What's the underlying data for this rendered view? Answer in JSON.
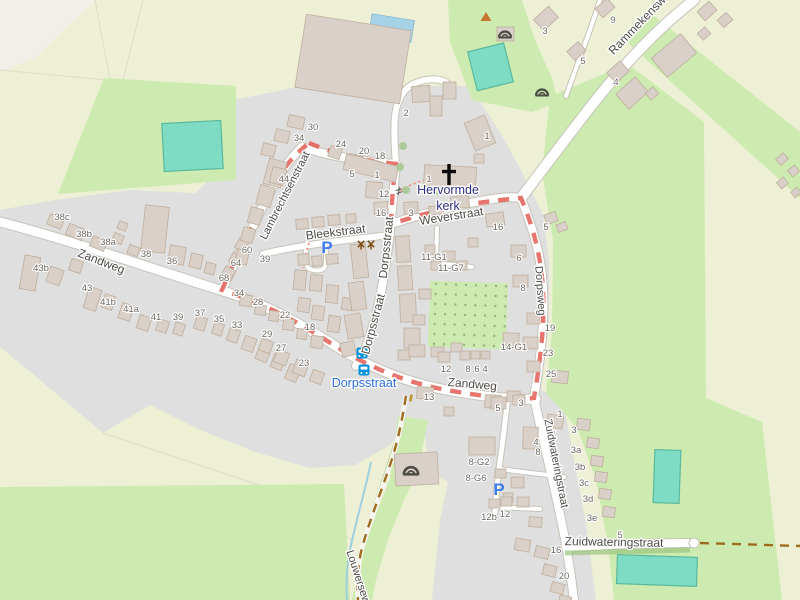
{
  "map_type": "openstreetmap-village",
  "colors": {
    "farmland": "#eef0d5",
    "bare_land": "#f2efe9",
    "grass": "#cdebb0",
    "residential": "#e0dfdf",
    "building_fill": "#d9d0c9",
    "building_stroke": "#bfae9c",
    "road_fill": "#ffffff",
    "road_casing": "#c6c3b8",
    "pitch_teal": "#7ddcc3",
    "pitch_stroke": "#59b89e",
    "pool_blue": "#a5d2e6",
    "stream_blue": "#9fcfdd",
    "orchard_dot": "#9aab84",
    "track_brown": "#9d6c1e",
    "route_red": "#e2574d",
    "footway_pink": "#fa8072",
    "street_text": "#4f4b47",
    "housenumber_text": "#6d6862",
    "church_text": "#2f2f85",
    "bus_label_blue": "#2a6fe0",
    "bus_icon_blue": "#0092da",
    "parking_blue": "#3b7cf0",
    "hedge_green": "#9ac47e",
    "tree_green": "#a8c894",
    "peak_orange": "#c77433",
    "icon_dark": "#4c4c44",
    "windmill_brown": "#7d4e14"
  },
  "street_labels": [
    {
      "text": "Zandweg",
      "x": 100,
      "y": 265,
      "rot": 21,
      "size": 12
    },
    {
      "text": "Lambrechtsenstraat",
      "x": 288,
      "y": 197,
      "rot": -63,
      "size": 11
    },
    {
      "text": "Bleekstraat",
      "x": 336,
      "y": 236,
      "rot": -7,
      "size": 12
    },
    {
      "text": "Dorpsstraat",
      "x": 390,
      "y": 248,
      "rot": -84,
      "size": 12
    },
    {
      "text": "Dorpsstraat",
      "x": 377,
      "y": 325,
      "rot": -75,
      "size": 12
    },
    {
      "text": "Weverstraat",
      "x": 452,
      "y": 220,
      "rot": -9,
      "size": 12
    },
    {
      "text": "Dorpsweg",
      "x": 537,
      "y": 291,
      "rot": 86,
      "size": 11
    },
    {
      "text": "Zuidwateringstraat",
      "x": 553,
      "y": 464,
      "rot": 79,
      "size": 11
    },
    {
      "text": "Zandweg",
      "x": 472,
      "y": 388,
      "rot": 5,
      "size": 12
    },
    {
      "text": "Zuidwateringstraat",
      "x": 614,
      "y": 546,
      "rot": 1,
      "size": 12
    },
    {
      "text": "Rammekensw",
      "x": 640,
      "y": 28,
      "rot": -46,
      "size": 12
    },
    {
      "text": "Louwersew",
      "x": 355,
      "y": 578,
      "rot": 72,
      "size": 11
    }
  ],
  "poi_labels": [
    {
      "text": "Hervormde",
      "x": 448,
      "y": 194,
      "size": 12.5,
      "color": "#2f2f85",
      "name": "church-label-line1"
    },
    {
      "text": "kerk",
      "x": 448,
      "y": 210,
      "size": 12.5,
      "color": "#2f2f85",
      "name": "church-label-line2"
    },
    {
      "text": "Dorpsstraat",
      "x": 364,
      "y": 387,
      "size": 12.5,
      "color": "#2a6fe0",
      "name": "bus-stop-label"
    }
  ],
  "house_numbers": [
    [
      62,
      217,
      "38c"
    ],
    [
      84,
      234,
      "38b"
    ],
    [
      108,
      242,
      "38a"
    ],
    [
      146,
      254,
      "38"
    ],
    [
      172,
      261,
      "36"
    ],
    [
      41,
      268,
      "43b"
    ],
    [
      87,
      288,
      "43"
    ],
    [
      108,
      302,
      "41b"
    ],
    [
      131,
      309,
      "41a"
    ],
    [
      156,
      317,
      "41"
    ],
    [
      178,
      317,
      "39"
    ],
    [
      200,
      313,
      "37"
    ],
    [
      219,
      319,
      "35"
    ],
    [
      237,
      325,
      "33"
    ],
    [
      247,
      250,
      "60"
    ],
    [
      236,
      263,
      "64"
    ],
    [
      224,
      278,
      "68"
    ],
    [
      239,
      293,
      "34"
    ],
    [
      258,
      302,
      "28"
    ],
    [
      265,
      259,
      "39"
    ],
    [
      285,
      315,
      "22"
    ],
    [
      310,
      327,
      "18"
    ],
    [
      267,
      334,
      "29"
    ],
    [
      281,
      348,
      "27"
    ],
    [
      304,
      363,
      "23"
    ],
    [
      313,
      127,
      "30"
    ],
    [
      299,
      138,
      "34"
    ],
    [
      341,
      144,
      "24"
    ],
    [
      364,
      151,
      "20"
    ],
    [
      380,
      156,
      "18"
    ],
    [
      284,
      179,
      "44"
    ],
    [
      352,
      174,
      "5"
    ],
    [
      377,
      175,
      "1"
    ],
    [
      406,
      113,
      "2"
    ],
    [
      384,
      194,
      "12"
    ],
    [
      429,
      179,
      "1"
    ],
    [
      381,
      213,
      "16"
    ],
    [
      411,
      213,
      "3"
    ],
    [
      487,
      136,
      "1"
    ],
    [
      434,
      257,
      "11-G1"
    ],
    [
      451,
      268,
      "11-G7"
    ],
    [
      498,
      227,
      "16"
    ],
    [
      519,
      258,
      "6"
    ],
    [
      523,
      288,
      "8"
    ],
    [
      514,
      347,
      "14-G1"
    ],
    [
      446,
      369,
      "12"
    ],
    [
      468,
      369,
      "8"
    ],
    [
      477,
      369,
      "6"
    ],
    [
      485,
      369,
      "4"
    ],
    [
      545,
      31,
      "3"
    ],
    [
      583,
      61,
      "5"
    ],
    [
      613,
      20,
      "9"
    ],
    [
      616,
      82,
      "4"
    ],
    [
      546,
      227,
      "5"
    ],
    [
      550,
      328,
      "19"
    ],
    [
      548,
      353,
      "23"
    ],
    [
      551,
      374,
      "25"
    ],
    [
      498,
      408,
      "5"
    ],
    [
      521,
      403,
      "3"
    ],
    [
      560,
      414,
      "1"
    ],
    [
      536,
      442,
      "4"
    ],
    [
      538,
      452,
      "8"
    ],
    [
      574,
      430,
      "3"
    ],
    [
      576,
      450,
      "3a"
    ],
    [
      580,
      467,
      "3b"
    ],
    [
      584,
      483,
      "3c"
    ],
    [
      588,
      499,
      "3d"
    ],
    [
      592,
      518,
      "3e"
    ],
    [
      479,
      462,
      "8-G2"
    ],
    [
      476,
      478,
      "8-G6"
    ],
    [
      489,
      517,
      "12b"
    ],
    [
      505,
      514,
      "12"
    ],
    [
      556,
      550,
      "16"
    ],
    [
      564,
      576,
      "20"
    ],
    [
      620,
      535,
      "5"
    ],
    [
      429,
      397,
      "13"
    ]
  ],
  "icons": [
    {
      "type": "bunker",
      "x": 505,
      "y": 33,
      "s": 1.0
    },
    {
      "type": "bunker",
      "x": 542,
      "y": 91,
      "s": 1.0
    },
    {
      "type": "bunker",
      "x": 411,
      "y": 469,
      "s": 1.2
    },
    {
      "type": "peak",
      "x": 486,
      "y": 17
    },
    {
      "type": "parking",
      "x": 327,
      "y": 247
    },
    {
      "type": "parking",
      "x": 499,
      "y": 489
    },
    {
      "type": "bus",
      "x": 362,
      "y": 353
    },
    {
      "type": "bus",
      "x": 364,
      "y": 370
    },
    {
      "type": "gate",
      "x": 399,
      "y": 191
    },
    {
      "type": "windmill",
      "x": 361,
      "y": 244
    },
    {
      "type": "windmill",
      "x": 371,
      "y": 244
    },
    {
      "type": "cross",
      "x": 449,
      "y": 175
    },
    {
      "type": "bollard",
      "x": 411,
      "y": 398
    }
  ],
  "trees": [
    [
      403,
      146
    ],
    [
      400,
      167
    ],
    [
      406,
      190
    ],
    [
      436,
      191
    ]
  ],
  "buildings": [
    [
      48,
      216,
      15,
      11,
      22
    ],
    [
      67,
      226,
      17,
      12,
      22
    ],
    [
      91,
      238,
      15,
      11,
      22
    ],
    [
      113,
      234,
      10,
      9,
      22
    ],
    [
      128,
      246,
      11,
      9,
      22
    ],
    [
      143,
      206,
      24,
      46,
      6
    ],
    [
      169,
      246,
      16,
      18,
      10
    ],
    [
      190,
      254,
      12,
      14,
      12
    ],
    [
      205,
      263,
      10,
      11,
      14
    ],
    [
      118,
      222,
      9,
      8,
      22
    ],
    [
      22,
      256,
      16,
      34,
      10
    ],
    [
      48,
      268,
      14,
      16,
      18
    ],
    [
      70,
      260,
      12,
      12,
      18
    ],
    [
      86,
      288,
      13,
      22,
      18
    ],
    [
      103,
      295,
      11,
      14,
      18
    ],
    [
      120,
      304,
      12,
      16,
      18
    ],
    [
      138,
      316,
      12,
      14,
      18
    ],
    [
      157,
      320,
      11,
      12,
      18
    ],
    [
      174,
      323,
      10,
      12,
      18
    ],
    [
      195,
      317,
      11,
      13,
      18
    ],
    [
      213,
      323,
      10,
      12,
      18
    ],
    [
      228,
      329,
      11,
      13,
      20
    ],
    [
      243,
      337,
      12,
      14,
      20
    ],
    [
      257,
      347,
      12,
      14,
      22
    ],
    [
      272,
      355,
      12,
      14,
      22
    ],
    [
      287,
      365,
      12,
      16,
      22
    ],
    [
      240,
      295,
      12,
      11,
      8
    ],
    [
      255,
      305,
      11,
      10,
      8
    ],
    [
      269,
      311,
      10,
      10,
      8
    ],
    [
      283,
      319,
      11,
      11,
      8
    ],
    [
      297,
      329,
      10,
      10,
      8
    ],
    [
      311,
      336,
      12,
      12,
      8
    ],
    [
      260,
      340,
      12,
      12,
      20
    ],
    [
      275,
      351,
      13,
      13,
      20
    ],
    [
      294,
      361,
      13,
      14,
      20
    ],
    [
      311,
      371,
      12,
      12,
      20
    ],
    [
      236,
      240,
      11,
      10,
      -60
    ],
    [
      230,
      254,
      11,
      10,
      -60
    ],
    [
      222,
      268,
      12,
      11,
      -60
    ],
    [
      266,
      160,
      18,
      26,
      15
    ],
    [
      258,
      186,
      15,
      20,
      15
    ],
    [
      249,
      208,
      13,
      16,
      15
    ],
    [
      242,
      228,
      12,
      14,
      15
    ],
    [
      236,
      250,
      12,
      14,
      12
    ],
    [
      288,
      116,
      16,
      12,
      12
    ],
    [
      275,
      130,
      14,
      12,
      13
    ],
    [
      262,
      144,
      13,
      12,
      14
    ],
    [
      271,
      168,
      14,
      16,
      14
    ],
    [
      329,
      147,
      12,
      11,
      18
    ],
    [
      350,
      155,
      12,
      11,
      16
    ],
    [
      371,
      161,
      12,
      11,
      14
    ],
    [
      344,
      160,
      54,
      16,
      14
    ],
    [
      366,
      182,
      16,
      16,
      4
    ],
    [
      300,
      22,
      106,
      74,
      9
    ],
    [
      412,
      86,
      18,
      16,
      -4
    ],
    [
      430,
      96,
      12,
      20,
      0
    ],
    [
      443,
      82,
      13,
      17,
      0
    ],
    [
      497,
      27,
      17,
      14,
      0
    ],
    [
      296,
      219,
      12,
      10,
      -4
    ],
    [
      312,
      217,
      12,
      10,
      -4
    ],
    [
      328,
      215,
      12,
      10,
      -4
    ],
    [
      346,
      214,
      10,
      9,
      -4
    ],
    [
      298,
      254,
      11,
      11,
      -4
    ],
    [
      312,
      256,
      10,
      10,
      -4
    ],
    [
      326,
      254,
      12,
      10,
      -4
    ],
    [
      294,
      270,
      12,
      20,
      5
    ],
    [
      310,
      275,
      12,
      16,
      5
    ],
    [
      326,
      285,
      12,
      18,
      5
    ],
    [
      298,
      298,
      12,
      14,
      8
    ],
    [
      312,
      306,
      12,
      14,
      8
    ],
    [
      328,
      316,
      12,
      16,
      8
    ],
    [
      342,
      298,
      10,
      12,
      8
    ],
    [
      352,
      244,
      15,
      34,
      -6
    ],
    [
      350,
      282,
      15,
      28,
      -8
    ],
    [
      346,
      314,
      16,
      24,
      -10
    ],
    [
      341,
      342,
      14,
      14,
      -14
    ],
    [
      396,
      236,
      14,
      26,
      -4
    ],
    [
      398,
      266,
      14,
      24,
      -4
    ],
    [
      400,
      294,
      16,
      28,
      -2
    ],
    [
      404,
      328,
      16,
      20,
      0
    ],
    [
      398,
      350,
      12,
      10,
      0
    ],
    [
      424,
      166,
      52,
      22,
      3
    ],
    [
      474,
      154,
      10,
      9,
      0
    ],
    [
      469,
      118,
      22,
      30,
      -22
    ],
    [
      451,
      196,
      18,
      12,
      -6
    ],
    [
      429,
      206,
      12,
      9,
      -6
    ],
    [
      374,
      202,
      14,
      12,
      -4
    ],
    [
      404,
      202,
      14,
      12,
      -4
    ],
    [
      486,
      213,
      18,
      13,
      -8
    ],
    [
      511,
      245,
      15,
      12,
      0
    ],
    [
      513,
      275,
      15,
      12,
      0
    ],
    [
      503,
      333,
      16,
      13,
      2
    ],
    [
      468,
      238,
      10,
      9,
      0
    ],
    [
      443,
      251,
      12,
      10,
      0
    ],
    [
      457,
      261,
      10,
      9,
      0
    ],
    [
      425,
      245,
      10,
      9,
      0
    ],
    [
      431,
      261,
      10,
      9,
      0
    ],
    [
      419,
      289,
      12,
      10,
      0
    ],
    [
      413,
      315,
      12,
      10,
      0
    ],
    [
      409,
      345,
      16,
      12,
      0
    ],
    [
      431,
      347,
      13,
      10,
      0
    ],
    [
      451,
      343,
      11,
      9,
      0
    ],
    [
      438,
      352,
      12,
      10,
      0
    ],
    [
      460,
      351,
      10,
      9,
      0
    ],
    [
      471,
      351,
      9,
      8,
      0
    ],
    [
      481,
      351,
      9,
      8,
      0
    ],
    [
      545,
      213,
      12,
      10,
      -20
    ],
    [
      557,
      223,
      10,
      8,
      -20
    ],
    [
      527,
      313,
      13,
      11,
      0
    ],
    [
      523,
      337,
      15,
      12,
      0
    ],
    [
      527,
      361,
      13,
      11,
      0
    ],
    [
      552,
      371,
      16,
      12,
      6
    ],
    [
      536,
      11,
      20,
      15,
      -42
    ],
    [
      569,
      45,
      15,
      12,
      -42
    ],
    [
      597,
      2,
      16,
      12,
      -42
    ],
    [
      609,
      65,
      18,
      14,
      -42
    ],
    [
      619,
      83,
      26,
      20,
      -42
    ],
    [
      647,
      89,
      10,
      9,
      -42
    ],
    [
      655,
      43,
      38,
      25,
      -40
    ],
    [
      699,
      5,
      16,
      12,
      -42
    ],
    [
      719,
      15,
      12,
      10,
      -42
    ],
    [
      699,
      29,
      10,
      9,
      -42
    ],
    [
      777,
      155,
      10,
      8,
      -40
    ],
    [
      789,
      167,
      9,
      8,
      -40
    ],
    [
      778,
      179,
      9,
      8,
      -40
    ],
    [
      792,
      189,
      8,
      7,
      -40
    ],
    [
      547,
      415,
      16,
      13,
      8
    ],
    [
      577,
      419,
      13,
      11,
      8
    ],
    [
      587,
      438,
      12,
      10,
      8
    ],
    [
      591,
      456,
      12,
      10,
      8
    ],
    [
      595,
      472,
      12,
      10,
      8
    ],
    [
      599,
      489,
      12,
      10,
      8
    ],
    [
      603,
      507,
      12,
      10,
      8
    ],
    [
      523,
      427,
      15,
      22,
      2
    ],
    [
      507,
      391,
      13,
      11,
      2
    ],
    [
      485,
      395,
      16,
      13,
      2
    ],
    [
      469,
      437,
      26,
      18,
      0
    ],
    [
      495,
      469,
      11,
      9,
      0
    ],
    [
      511,
      477,
      13,
      11,
      0
    ],
    [
      503,
      493,
      10,
      9,
      0
    ],
    [
      517,
      497,
      12,
      10,
      0
    ],
    [
      529,
      517,
      13,
      10,
      4
    ],
    [
      515,
      539,
      15,
      12,
      10
    ],
    [
      535,
      547,
      14,
      11,
      14
    ],
    [
      543,
      565,
      13,
      11,
      14
    ],
    [
      551,
      583,
      13,
      10,
      14
    ],
    [
      559,
      596,
      12,
      9,
      14
    ],
    [
      489,
      499,
      11,
      9,
      0
    ],
    [
      501,
      497,
      11,
      9,
      0
    ],
    [
      417,
      387,
      16,
      12,
      4
    ],
    [
      444,
      407,
      10,
      9,
      0
    ],
    [
      491,
      397,
      15,
      12,
      0
    ],
    [
      513,
      395,
      12,
      10,
      0
    ],
    [
      395,
      453,
      43,
      32,
      -3
    ]
  ]
}
